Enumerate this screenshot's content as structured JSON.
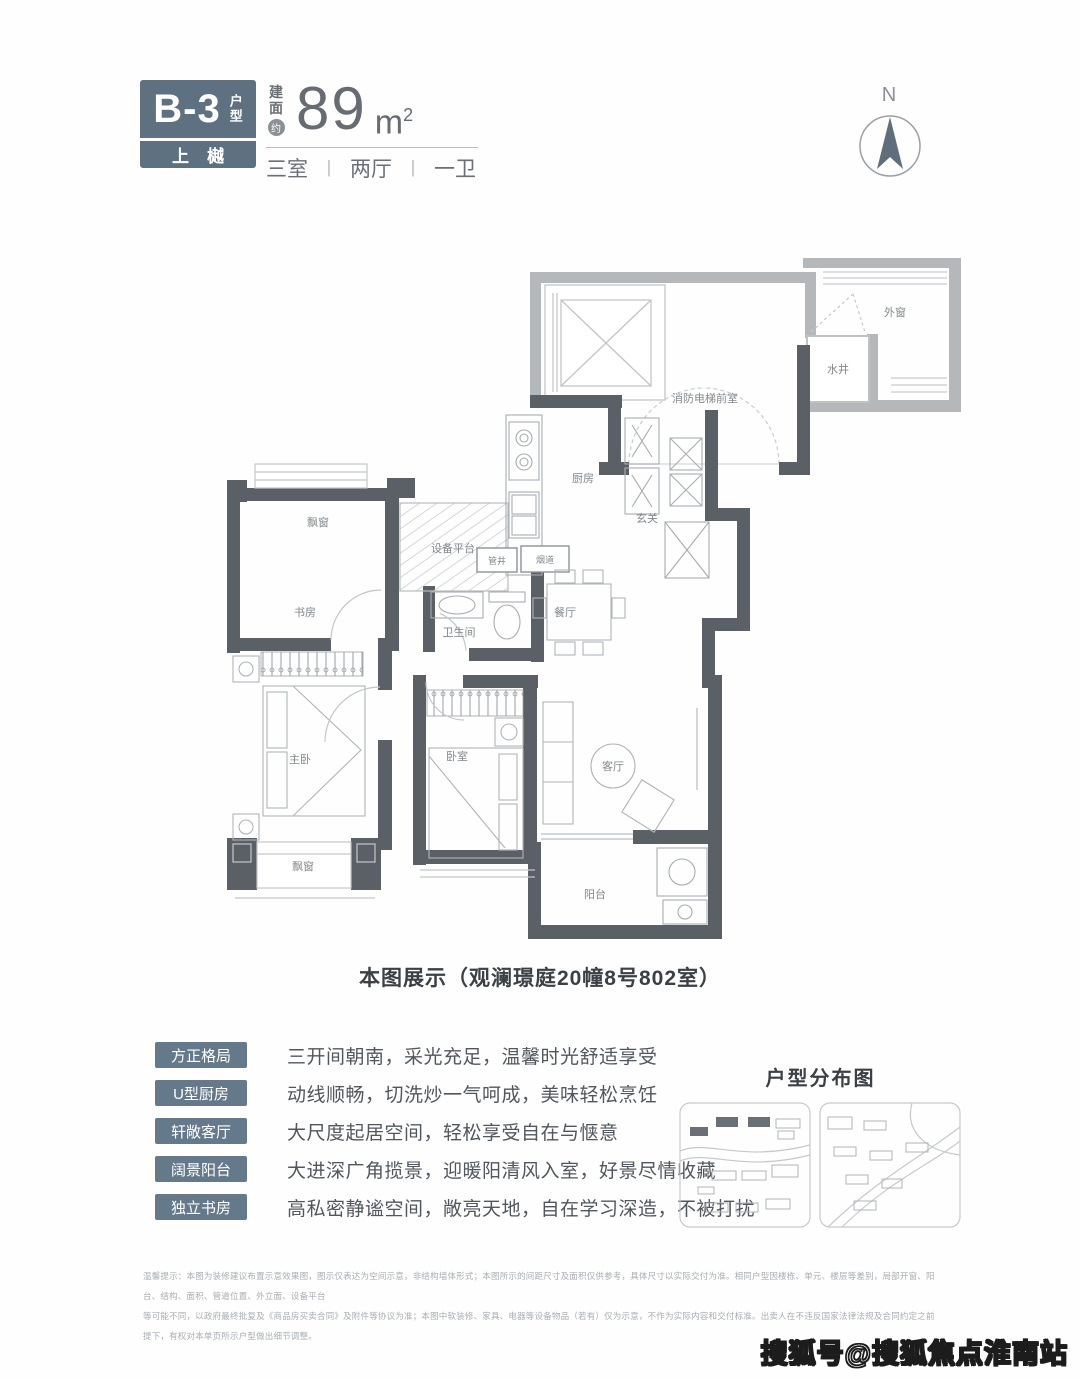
{
  "header": {
    "unit_code": "B-3",
    "unit_code_suffix": "户型",
    "project_badge": "上樾",
    "area_prefix_1": "建",
    "area_prefix_2": "面",
    "area_approx": "约",
    "area_value": "89",
    "area_unit": "m",
    "area_unit_sup": "2",
    "layout_rooms": "三室",
    "layout_halls": "两厅",
    "layout_baths": "一卫",
    "badge_color": "#5d7181"
  },
  "compass": {
    "north_label": "N"
  },
  "plan": {
    "rooms": {
      "elevator_lobby": "消防电梯前室",
      "outer_window": "外窗",
      "water_well": "水井",
      "kitchen": "厨房",
      "entry": "玄关",
      "equipment_platform": "设备平台",
      "flue": "烟道",
      "pipe_shaft": "管井",
      "bathroom": "卫生间",
      "dining": "餐厅",
      "study": "书房",
      "bay_window_top": "飘窗",
      "master_bedroom": "主卧",
      "bedroom": "卧室",
      "living": "客厅",
      "bay_window_bottom": "飘窗",
      "balcony": "阳台"
    },
    "caption": "本图展示（观澜璟庭20幢8号802室）"
  },
  "features": {
    "items": [
      {
        "tag": "方正格局",
        "desc": "三开间朝南，采光充足，温馨时光舒适享受"
      },
      {
        "tag": "U型厨房",
        "desc": "动线顺畅，切洗炒一气呵成，美味轻松烹饪"
      },
      {
        "tag": "轩敞客厅",
        "desc": "大尺度起居空间，轻松享受自在与惬意"
      },
      {
        "tag": "阔景阳台",
        "desc": "大进深广角揽景，迎暖阳清风入室，好景尽情收藏"
      },
      {
        "tag": "独立书房",
        "desc": "高私密静谧空间，敞亮天地，自在学习深造，不被打扰"
      }
    ]
  },
  "distribution": {
    "title": "户型分布图"
  },
  "disclaimer": {
    "line1": "温馨提示：本图为装修建议布置示意效果图，图示仅表达为空间示意，非结构墙体形式；本图所示的间距尺寸及面积仅供参考，具体尺寸以实际交付为准。相同户型因楼栋、单元、楼层等差别，局部开窗、阳台、结构、面积、管道位置、外立面、设备平台",
    "line2": "等可能不同，以政府最终批复及《商品房买卖合同》及附件等协议为准；本图中软装修、家具、电器等设备物品（若有）仅为示意，不作为实际内容和交付标准。出卖人在不违反国家法律法规及合同约定之前提下，有权对本单页所示户型做出细节调整。"
  },
  "watermark": "搜狐号@搜狐焦点淮南站"
}
